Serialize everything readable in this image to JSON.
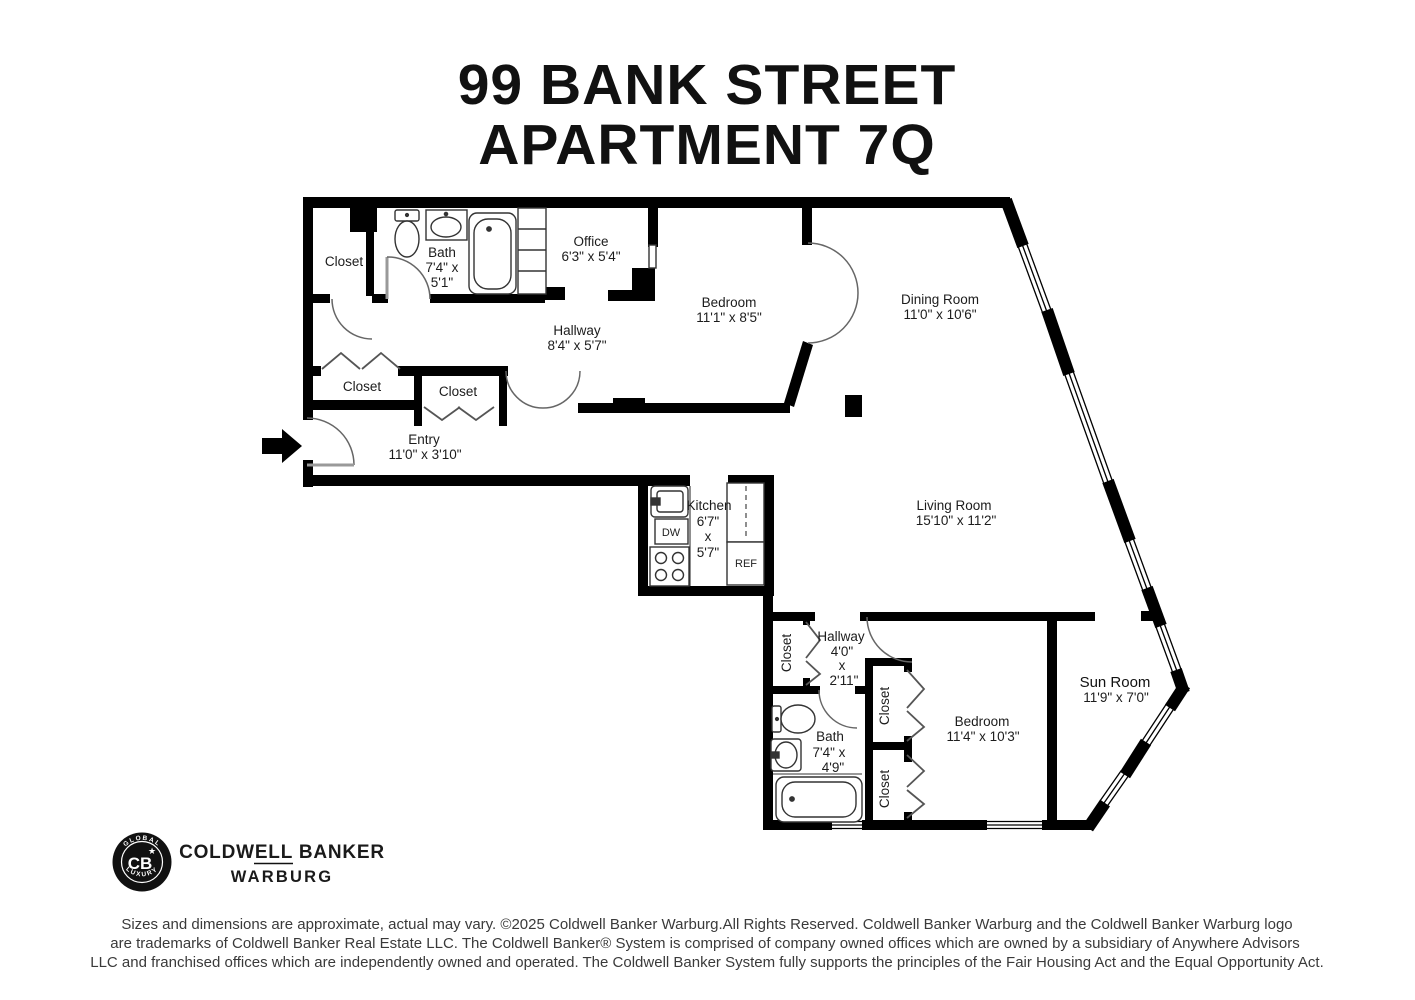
{
  "title": {
    "line1": "99 BANK STREET",
    "line2": "APARTMENT 7Q"
  },
  "rooms": {
    "closet_top": {
      "name": "Closet"
    },
    "bath_top": {
      "name": "Bath",
      "dim_line1": "7'4\" x",
      "dim_line2": "5'1\""
    },
    "office": {
      "name": "Office",
      "dims": "6'3\" x 5'4\""
    },
    "hallway_top": {
      "name": "Hallway",
      "dims": "8'4\" x 5'7\""
    },
    "bedroom_top": {
      "name": "Bedroom",
      "dims": "11'1\" x 8'5\""
    },
    "dining_room": {
      "name": "Dining Room",
      "dims": "11'0\" x 10'6\""
    },
    "closet_mid_left": {
      "name": "Closet"
    },
    "closet_mid_right": {
      "name": "Closet"
    },
    "entry": {
      "name": "Entry",
      "dims": "11'0\" x 3'10\""
    },
    "kitchen": {
      "name": "Kitchen",
      "dim_line1": "6'7\"",
      "dim_line2": "x",
      "dim_line3": "5'7\""
    },
    "living_room": {
      "name": "Living Room",
      "dims": "15'10\" x 11'2\""
    },
    "closet_lower_hall": {
      "name": "Closet"
    },
    "hallway_lower": {
      "name": "Hallway",
      "dim_line1": "4'0\"",
      "dim_line2": "x",
      "dim_line3": "2'11\""
    },
    "bath_lower": {
      "name": "Bath",
      "dim_line1": "7'4\" x",
      "dim_line2": "4'9\""
    },
    "closet_bedroom_upper": {
      "name": "Closet"
    },
    "closet_bedroom_lower": {
      "name": "Closet"
    },
    "bedroom_lower": {
      "name": "Bedroom",
      "dims": "11'4\" x 10'3\""
    },
    "sun_room": {
      "name": "Sun Room",
      "dims": "11'9\" x 7'0\""
    }
  },
  "appliances": {
    "dishwasher": "DW",
    "refrigerator": "REF"
  },
  "logo": {
    "badge_top": "GLOBAL",
    "badge_bottom": "LUXURY",
    "monogram": "CB",
    "star": "★",
    "wordmark": "COLDWELL BANKER",
    "division": "WARBURG"
  },
  "disclaimer": {
    "line1": "Sizes and dimensions are approximate, actual may vary. ©2025 Coldwell Banker Warburg.All Rights Reserved. Coldwell Banker Warburg and the Coldwell Banker Warburg logo",
    "line2": "are trademarks of Coldwell Banker Real Estate LLC. The Coldwell Banker® System is comprised of company owned offices which are owned by a subsidiary of Anywhere Advisors",
    "line3": "LLC and franchised offices which are independently owned and operated. The Coldwell Banker System fully supports the principles of the Fair Housing Act and the Equal Opportunity Act."
  },
  "colors": {
    "wall": "#000000",
    "label_text": "#1c1c1c",
    "disclaimer_text": "#3a3a3a",
    "background": "#ffffff"
  }
}
